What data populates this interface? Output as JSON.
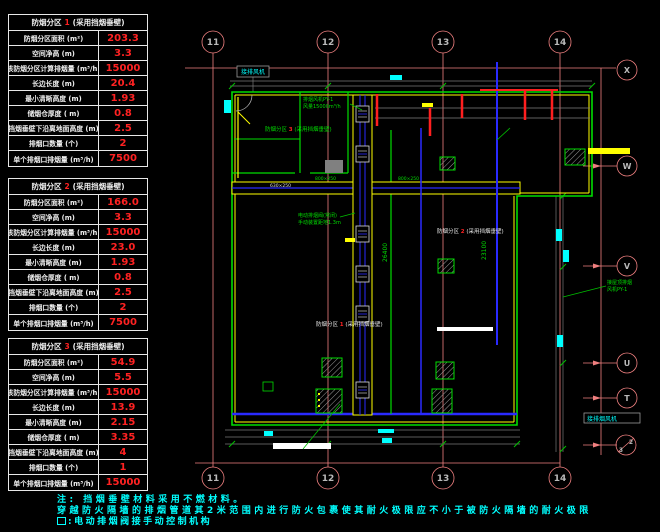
{
  "tables": [
    {
      "title_prefix": "防烟分区",
      "zone": "1",
      "title_suffix": "(采用挡烟垂壁)",
      "rows": [
        {
          "label": "防烟分区面积 (m²)",
          "value": "203.3"
        },
        {
          "label": "空间净高 (m)",
          "value": "3.3"
        },
        {
          "label": "该防烟分区计算排烟量 (m³/h)",
          "value": "15000"
        },
        {
          "label": "长边长度  (m)",
          "value": "20.4"
        },
        {
          "label": "最小清晰高度 (m)",
          "value": "1.93"
        },
        {
          "label": "储烟仓厚度 ( m)",
          "value": "0.8"
        },
        {
          "label": "挡烟垂壁下沿离地面高度 (m)",
          "value": "2.5"
        },
        {
          "label": "排烟口数量  (个)",
          "value": "2"
        },
        {
          "label": "单个排烟口排烟量 (m³/h)",
          "value": "7500"
        }
      ]
    },
    {
      "title_prefix": "防烟分区",
      "zone": "2",
      "title_suffix": "(采用挡烟垂壁)",
      "rows": [
        {
          "label": "防烟分区面积 (m²)",
          "value": "166.0"
        },
        {
          "label": "空间净高 (m)",
          "value": "3.3"
        },
        {
          "label": "该防烟分区计算排烟量 (m³/h)",
          "value": "15000"
        },
        {
          "label": "长边长度  (m)",
          "value": "23.0"
        },
        {
          "label": "最小清晰高度 (m)",
          "value": "1.93"
        },
        {
          "label": "储烟仓厚度 ( m)",
          "value": "0.8"
        },
        {
          "label": "挡烟垂壁下沿离地面高度 (m)",
          "value": "2.5"
        },
        {
          "label": "排烟口数量  (个)",
          "value": "2"
        },
        {
          "label": "单个排烟口排烟量 (m³/h)",
          "value": "7500"
        }
      ]
    },
    {
      "title_prefix": "防烟分区",
      "zone": "3",
      "title_suffix": "(采用挡烟垂壁)",
      "rows": [
        {
          "label": "防烟分区面积 (m²)",
          "value": "54.9"
        },
        {
          "label": "空间净高 (m)",
          "value": "5.5"
        },
        {
          "label": "该防烟分区计算排烟量 (m³/h)",
          "value": "15000"
        },
        {
          "label": "长边长度  (m)",
          "value": "13.9"
        },
        {
          "label": "最小清晰高度 (m)",
          "value": "2.15"
        },
        {
          "label": "储烟仓厚度 ( m)",
          "value": "3.35"
        },
        {
          "label": "挡烟垂壁下沿离地面高度 (m)",
          "value": "4"
        },
        {
          "label": "排烟口数量  (个)",
          "value": "1"
        },
        {
          "label": "单个排烟口排烟量 (m³/h)",
          "value": "15000"
        }
      ]
    }
  ],
  "notes": {
    "line1": "注: 挡烟垂壁材料采用不燃材料。",
    "line2": "穿越防火隔墙的排烟管道其2米范围内进行防火包裹使其耐火极限应不小于被防火隔墙的耐火极限",
    "line3": ":电动排烟阀接手动控制机构"
  },
  "plan": {
    "grid": {
      "top": [
        "11",
        "12",
        "13",
        "14"
      ],
      "bottom": [
        "11",
        "12",
        "13",
        "14"
      ],
      "right": [
        "X",
        "W",
        "V",
        "U",
        "T"
      ],
      "right_split_top": "2",
      "right_split_bottom": "3"
    },
    "zones": [
      {
        "prefix": "防烟分区",
        "num": "3",
        "suffix": "(采用挡烟垂壁)"
      },
      {
        "prefix": "防烟分区",
        "num": "2",
        "suffix": "(采用挡烟垂壁)"
      },
      {
        "prefix": "防烟分区",
        "num": "1",
        "suffix": "(采用挡烟垂壁)"
      }
    ],
    "annotations": {
      "fan_line1": "排烟风机PY-1",
      "fan_line2": "风量15000m³/h",
      "valve_line1": "电动排烟阀(常闭)",
      "valve_line2": "手动装置距地1.3m",
      "right_note1": "接屋顶排烟",
      "right_note2": "风机PY-1",
      "left_box": "接排风机",
      "right_box": "接排烟风机",
      "dim_left": "26400",
      "dim_right": "23100",
      "duct_size_a": "800×250",
      "duct_size_b": "630×250"
    },
    "colors": {
      "value_red": "#ff2222",
      "note_cyan": "#00ffff",
      "grid_pink": "#f08080",
      "wall_green": "#00dd00",
      "duct_blue": "#2a2aff",
      "accent_yellow": "#ffff00"
    }
  }
}
